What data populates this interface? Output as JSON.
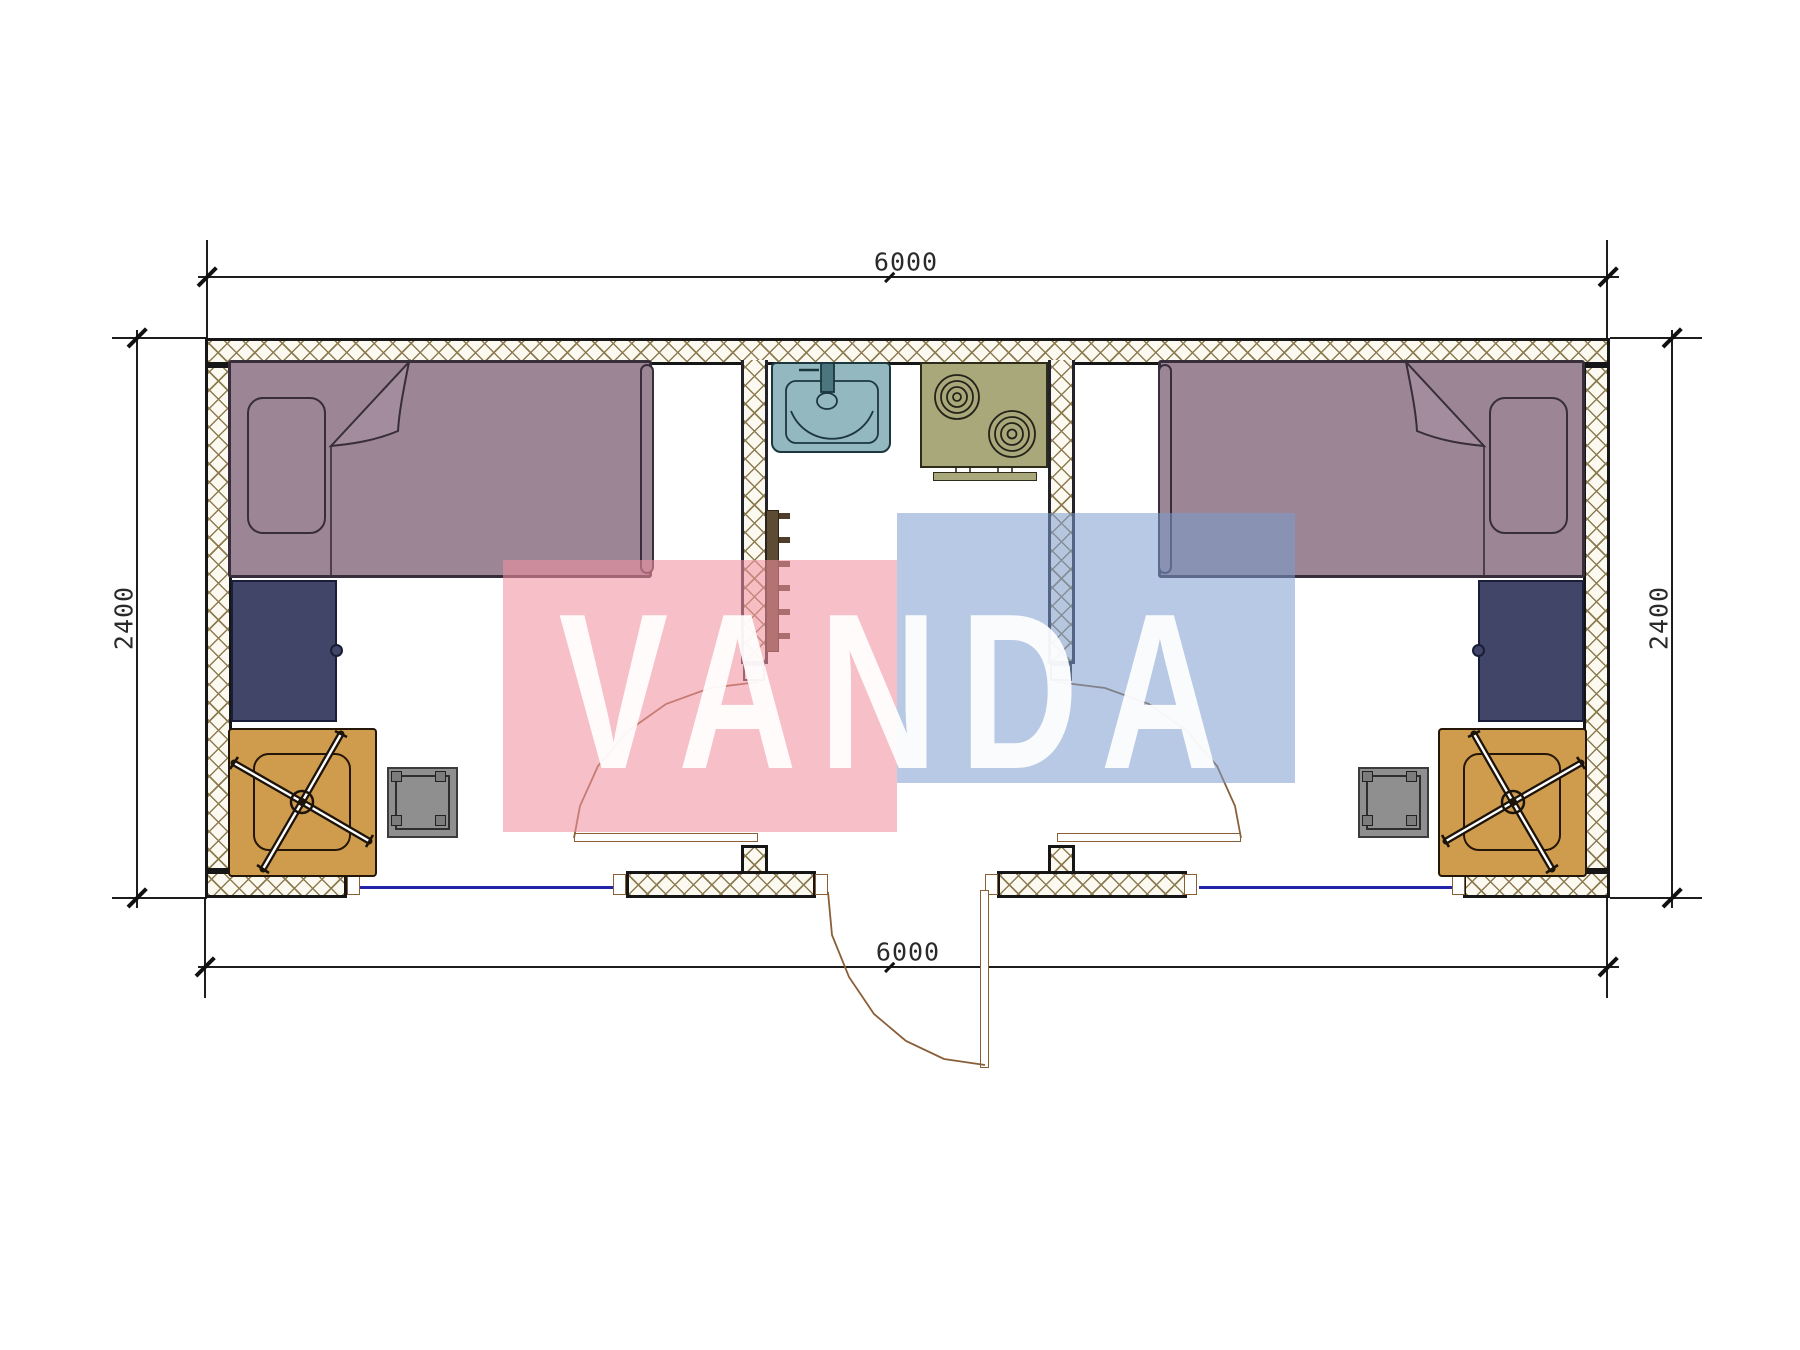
{
  "labels": {
    "width_top": "6000",
    "width_bottom": "6000",
    "height_left": "2400",
    "height_right": "2400"
  },
  "watermark": {
    "text": "VANDA"
  },
  "palette": {
    "ink": "#161616",
    "hatch-line": "#8d7c52",
    "wall-bg": "#fcf9f1",
    "bed": "#9c8594",
    "bed-line": "#382d3b",
    "navy": "#414568",
    "orange": "#cf9c4d",
    "stool": "#8f8f8f",
    "sink": "#93b8c0",
    "stove": "#a8a87a",
    "shelf": "#5d4b34",
    "door-tan": "#8a5f38",
    "window-blue": "#2424a8",
    "wm-pink": "rgba(241,145,160,0.58)",
    "wm-blue": "rgba(123,156,205,0.55)"
  },
  "plan": {
    "type": "floor-plan",
    "overall_width_mm": 6000,
    "overall_depth_mm": 2400,
    "rooms": [
      "bedroom-left",
      "kitchen-bath-center",
      "bedroom-right"
    ],
    "symbols": [
      "single-bed",
      "pillow",
      "desk-cabinet",
      "office-chair",
      "stool",
      "wash-basin",
      "two-burner-stove",
      "wall-shelf",
      "swing-door",
      "window"
    ]
  }
}
